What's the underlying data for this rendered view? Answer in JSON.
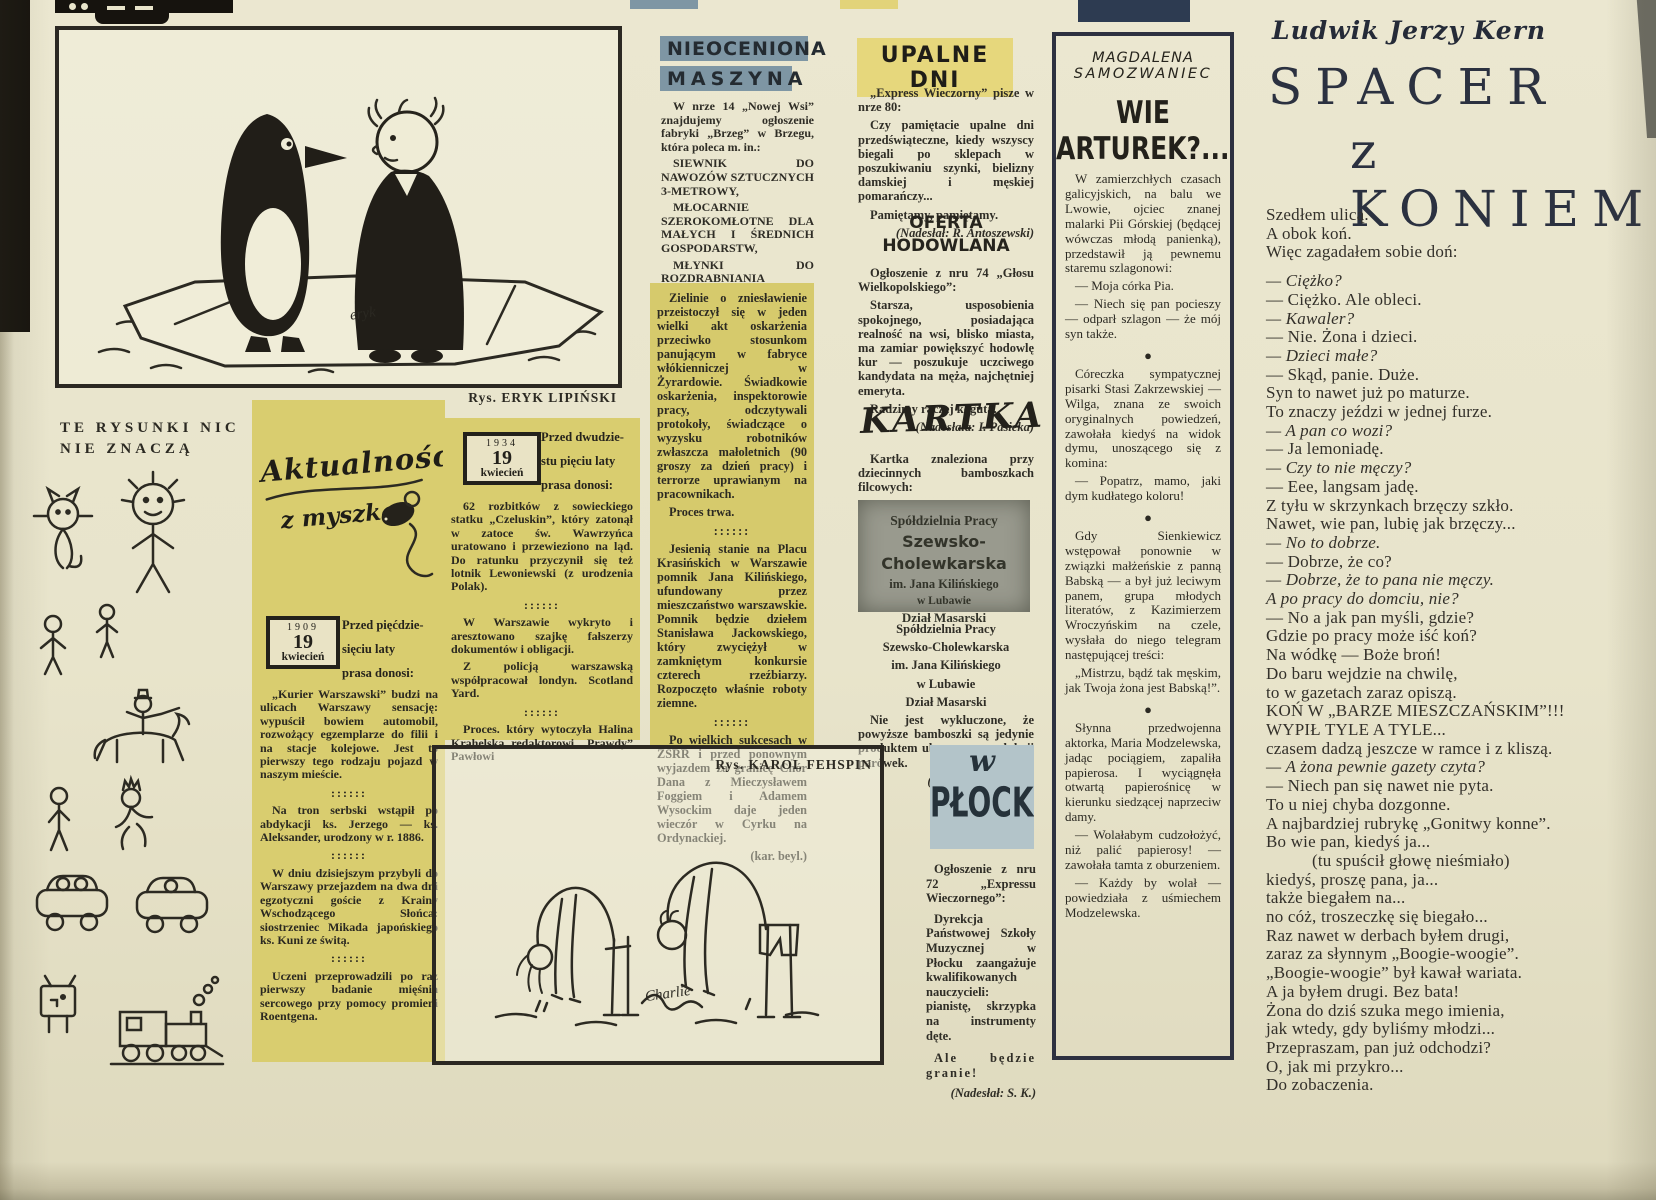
{
  "colors": {
    "paper": "#e8e4cb",
    "highlight_yellow": "#d9cd6f",
    "green_box": "#d6ca6c",
    "header_blue": "#7e96a4",
    "header_yellow": "#e6d77c",
    "plocku_blue": "#b3c4c9",
    "clipping_gray": "#999a8e",
    "masthead_navy": "#2d3b51",
    "ink": "#2b2922"
  },
  "doodles": {
    "header_line1": "TE RYSUNKI NIC",
    "header_line2": "NIE ZNACZĄ"
  },
  "cartoon_top": {
    "caption": "Rys. ERYK LIPIŃSKI",
    "signature": "eryk"
  },
  "cartoon_bottom": {
    "caption": "Rys. KAROL FEHSPIN",
    "signature": "Charlie"
  },
  "aktualnosci": {
    "logo_line1": "Aktualności",
    "logo_line2": "z myszką",
    "stamp1": {
      "year": "1909",
      "day": "19",
      "month": "kwiecień"
    },
    "stamp1_intro": [
      "Przed pięćdzie-",
      "sięciu laty",
      "prasa donosi:"
    ],
    "col1_paras": [
      {
        "t": "„Kurier Warszawski” budzi na ulicach Warszawy sensację: wypuścił bowiem automobil, rozwożący egzemplarze do filii i na stacje kolejowe. Jest to pierwszy tego rodzaju pojazd w naszym mieście.",
        "s": ""
      },
      {
        "t": "::::::",
        "s": "divider"
      },
      {
        "t": "Na tron serbski wstąpił po abdykacji ks. Jerzego — ks. Aleksander, urodzony w r. 1886.",
        "s": ""
      },
      {
        "t": "::::::",
        "s": "divider"
      },
      {
        "t": "W dniu dzisiejszym przybyli do Warszawy przejazdem na dwa dni egzotyczni goście z Krainy Wschodzącego Słońca: siostrzeniec Mikada japońskiego ks. Kuni ze świtą.",
        "s": ""
      },
      {
        "t": "::::::",
        "s": "divider"
      },
      {
        "t": "Uczeni przeprowadzili po raz pierwszy badanie mięśnia sercowego przy pomocy promieni Roentgena.",
        "s": ""
      }
    ],
    "stamp2": {
      "year": "1934",
      "day": "19",
      "month": "kwiecień"
    },
    "stamp2_intro": [
      "Przed dwudzie-",
      "stu pięciu laty",
      "prasa donosi:"
    ],
    "col2_paras": [
      {
        "t": "62 rozbitków z sowieckiego statku „Czeluskin”, który zatonął w zatoce św. Wawrzyńca uratowano i przewieziono na ląd. Do ratunku przyczynił się też lotnik Lewoniewski (z urodzenia Polak).",
        "s": ""
      },
      {
        "t": "::::::",
        "s": "divider"
      },
      {
        "t": "W Warszawie wykryto i aresztowano szajkę fałszerzy dokumentów i obligacji.",
        "s": ""
      },
      {
        "t": "Z policją warszawską współpracował londyn. Scotland Yard.",
        "s": ""
      },
      {
        "t": "::::::",
        "s": "divider"
      },
      {
        "t": "Proces. który wytoczyła Halina Krahelska redaktorowi „Prawdy” Pawłowi",
        "s": ""
      }
    ]
  },
  "nieoceniona": {
    "title_line1": "NIEOCENIONA",
    "title_line2": "MASZYNA",
    "paras": [
      {
        "t": "W nrze 14 „Nowej Wsi” znajdujemy ogłoszenie fabryki „Brzeg” w Brzegu, która poleca m. in.:",
        "s": ""
      },
      {
        "t": "SIEWNIK DO NAWOZÓW SZTUCZNYCH 3-METROWY,",
        "s": "bold"
      },
      {
        "t": "MŁOCARNIE SZEROKOMŁOTNE DLA MAŁYCH I ŚREDNICH GOSPODARSTW,",
        "s": "bold"
      },
      {
        "t": "MŁYNKI DO ROZDRABNIANIA NAWOZÓW MRN.",
        "s": "bold"
      },
      {
        "t": "Po zbyt długich posiedzeniach.",
        "s": ""
      },
      {
        "t": "(Nadesłał: B. Buharewicz)",
        "s": "credit"
      }
    ]
  },
  "greenbox": {
    "paras": [
      {
        "t": "Zielinie o zniesławienie przeistoczył się w jeden wielki akt oskarżenia przeciwko stosunkom panującym w fabryce włókienniczej w Żyrardowie. Świadkowie oskarżenia, inspektorowie pracy, odczytywali protokoły, świadczące o wyzysku robotników zwłaszcza małoletnich (90 groszy za dzień pracy) i terrorze uprawianym na pracownikach.",
        "s": ""
      },
      {
        "t": "Proces trwa.",
        "s": ""
      },
      {
        "t": "::::::",
        "s": "divider"
      },
      {
        "t": "Jesienią stanie na Placu Krasińskich w Warszawie pomnik Jana Kilińskiego, ufundowany przez mieszczaństwo warszawskie. Pomnik będzie dziełem Stanisława Jackowskiego, który zwyciężył w zamkniętym konkursie czterech rzeźbiarzy. Rozpoczęto właśnie roboty ziemne.",
        "s": ""
      },
      {
        "t": "::::::",
        "s": "divider"
      },
      {
        "t": "Po wielkich sukcesach w ZSRR i przed ponownym wyjazdem za granicę Chór Dana z Mieczysławem Foggiem i Adamem Wysockim daje jeden wieczór w Cyrku na Ordynackiej.",
        "s": ""
      },
      {
        "t": "(kar. beyl.)",
        "s": "creditb"
      }
    ]
  },
  "upalne": {
    "title": "UPALNE DNI",
    "paras": [
      {
        "t": "„Express Wieczorny” pisze w nrze 80:",
        "s": ""
      },
      {
        "t": "Czy pamiętacie upalne dni przedświąteczne, kiedy wszyscy biegali po sklepach w poszukiwaniu szynki, bielizny damskiej i męskiej pomarańczy...",
        "s": ""
      },
      {
        "t": "Pamiętamy, pamiętamy.",
        "s": ""
      },
      {
        "t": "(Nadesłał: R. Antoszewski)",
        "s": "credit"
      }
    ]
  },
  "oferta": {
    "title_line1": "OFERTA",
    "title_line2": "HODOWLANA",
    "paras": [
      {
        "t": "Ogłoszenie z nru 74 „Głosu Wielkopolskiego”:",
        "s": ""
      },
      {
        "t": "Starsza, usposobienia spokojnego, posiadająca realność na wsi, blisko miasta, ma zamiar powiększyć hodowlę kur — poszukuje uczciwego kandydata na męża, najchętniej emeryta.",
        "s": ""
      },
      {
        "t": "Radzimy raczej koguta.",
        "s": ""
      },
      {
        "t": "(Nadesłała: I. Pasieka)",
        "s": "credit"
      }
    ]
  },
  "kartka": {
    "title": "KARTKA",
    "intro_paras": [
      {
        "t": "Kartka znaleziona przy dziecinnych bamboszkach filcowych:",
        "s": ""
      }
    ],
    "clipping": [
      "Spółdzielnia Pracy",
      "Szewsko-Cholewkarska",
      "im. Jana Kilińskiego",
      "w Lubawie",
      "Dział Masarski"
    ],
    "paras": [
      {
        "t": "Spółdzielnia Pracy",
        "s": "cb"
      },
      {
        "t": "Szewsko-Cholewkarska",
        "s": "cb"
      },
      {
        "t": "im. Jana Kilińskiego",
        "s": "cb"
      },
      {
        "t": "w Lubawie",
        "s": "cb"
      },
      {
        "t": "Dział Masarski",
        "s": "cb"
      },
      {
        "t": "Nie jest wykluczone, że powyższe bamboszki są jedynie produktem ubocznym produkcji parówek.",
        "s": ""
      },
      {
        "t": "(Nadesłała: D. Beer)",
        "s": "credit"
      }
    ]
  },
  "plocku": {
    "title_w": "w",
    "title_name": "PŁOCKU",
    "paras": [
      {
        "t": "Ogłoszenie z nru 72 „Expressu Wieczornego”:",
        "s": ""
      },
      {
        "t": "Dyrekcja Państwowej Szkoły Muzycznej w Płocku zaangażuje kwalifikowanych nauczycieli: pianistę, skrzypka na instrumenty dęte.",
        "s": ""
      },
      {
        "t": "Ale będzie granie!",
        "s": "spaced"
      },
      {
        "t": "(Nadesłał: S. K.)",
        "s": "credit"
      }
    ]
  },
  "samozwaniec": {
    "author_line1": "MAGDALENA",
    "author_line2": "SAMOZWANIEC",
    "title": "WIE ARTUREK?....",
    "paras": [
      {
        "t": "W zamierzchłych czasach galicyjskich, na balu we Lwowie, ojciec znanej malarki Pii Górskiej (będącej wówczas młodą panienką), przedstawił ją pewnemu staremu szlagonowi:",
        "s": ""
      },
      {
        "t": "— Moja córka Pia.",
        "s": ""
      },
      {
        "t": "— Niech się pan pocieszy — odparł szlagon — że mój syn także.",
        "s": ""
      },
      {
        "t": "●",
        "s": "bullet"
      },
      {
        "t": "Córeczka sympatycznej pisarki Stasi Zakrzewskiej — Wilga, znana ze swoich oryginalnych powiedzeń, zawołała kiedyś na widok dymu, unoszącego się z komina:",
        "s": ""
      },
      {
        "t": "— Popatrz, mamo, jaki dym kudłatego koloru!",
        "s": ""
      },
      {
        "t": "●",
        "s": "bullet"
      },
      {
        "t": "Gdy Sienkiewicz wstępował ponownie w związki małżeńskie z panną Babską — a był już leciwym panem, grupa młodych literatów, z Kazimierzem Wroczyńskim na czele, wysłała do niego telegram następującej treści:",
        "s": ""
      },
      {
        "t": "„Mistrzu, bądź tak męskim, jak Twoja żona jest Babską!”.",
        "s": ""
      },
      {
        "t": "●",
        "s": "bullet"
      },
      {
        "t": "Słynna przedwojenna aktorka, Maria Modzelewska, jadąc pociągiem, zapaliła papierosa. I wyciągnęła otwartą papierośnicę w kierunku siedzącej naprzeciw damy.",
        "s": ""
      },
      {
        "t": "— Wolałabym cudzołożyć, niż palić papierosy! — zawołała tamta z oburzeniem.",
        "s": ""
      },
      {
        "t": "— Każdy by wolał — powiedziała z uśmiechem Modzelewska.",
        "s": ""
      }
    ]
  },
  "kern": {
    "author": "Ludwik Jerzy Kern",
    "title_line1": "SPACER",
    "title_line2": "z KONIEM",
    "poem": [
      {
        "t": "Szedłem ulicą.",
        "s": ""
      },
      {
        "t": "A obok koń.",
        "s": ""
      },
      {
        "t": "Więc zagadałem sobie doń:",
        "s": ""
      },
      {
        "t": "",
        "s": "gap"
      },
      {
        "t": "— Ciężko?",
        "s": "i"
      },
      {
        "t": "— Ciężko. Ale obleci.",
        "s": ""
      },
      {
        "t": "— Kawaler?",
        "s": "i"
      },
      {
        "t": "— Nie. Żona i dzieci.",
        "s": ""
      },
      {
        "t": "— Dzieci małe?",
        "s": "i"
      },
      {
        "t": "— Skąd, panie. Duże.",
        "s": ""
      },
      {
        "t": "Syn to nawet już po maturze.",
        "s": ""
      },
      {
        "t": "To znaczy jeździ w jednej furze.",
        "s": ""
      },
      {
        "t": "— A pan co wozi?",
        "s": "i"
      },
      {
        "t": "— Ja lemoniadę.",
        "s": ""
      },
      {
        "t": "— Czy to nie męczy?",
        "s": "i"
      },
      {
        "t": "— Eee, langsam jadę.",
        "s": ""
      },
      {
        "t": "Z tyłu w skrzynkach brzęczy szkło.",
        "s": ""
      },
      {
        "t": "Nawet, wie pan, lubię jak brzęczy...",
        "s": ""
      },
      {
        "t": "— No to dobrze.",
        "s": "i"
      },
      {
        "t": "— Dobrze, że co?",
        "s": ""
      },
      {
        "t": "— Dobrze, że to pana nie męczy.",
        "s": "i"
      },
      {
        "t": "A po pracy do domciu, nie?",
        "s": "i"
      },
      {
        "t": "— No a jak pan myśli, gdzie?",
        "s": ""
      },
      {
        "t": "Gdzie po pracy może iść koń?",
        "s": ""
      },
      {
        "t": "Na wódkę — Boże broń!",
        "s": ""
      },
      {
        "t": "Do baru wejdzie na chwilę,",
        "s": ""
      },
      {
        "t": "to w gazetach zaraz opiszą.",
        "s": ""
      },
      {
        "t": "KOŃ W „BARZE MIESZCZAŃSKIM”!!!",
        "s": ""
      },
      {
        "t": "WYPIŁ TYLE A TYLE...",
        "s": ""
      },
      {
        "t": "czasem dadzą jeszcze w ramce i z kliszą.",
        "s": ""
      },
      {
        "t": "— A żona pewnie gazety czyta?",
        "s": "i"
      },
      {
        "t": "— Niech pan się nawet nie pyta.",
        "s": ""
      },
      {
        "t": "To u niej chyba dozgonne.",
        "s": ""
      },
      {
        "t": "A najbardziej rubrykę „Gonitwy konne”.",
        "s": ""
      },
      {
        "t": "Bo wie pan, kiedyś ja...",
        "s": ""
      },
      {
        "t": "(tu spuścił głowę nieśmiało)",
        "s": "ind"
      },
      {
        "t": "kiedyś, proszę pana, ja...",
        "s": ""
      },
      {
        "t": "także biegałem na...",
        "s": ""
      },
      {
        "t": "no cóż, troszeczkę się biegało...",
        "s": ""
      },
      {
        "t": "Raz nawet w derbach byłem drugi,",
        "s": ""
      },
      {
        "t": "zaraz za słynnym „Boogie-woogie”.",
        "s": ""
      },
      {
        "t": "„Boogie-woogie” był kawał wariata.",
        "s": ""
      },
      {
        "t": "A ja byłem drugi. Bez bata!",
        "s": ""
      },
      {
        "t": "Żona do dziś szuka mego imienia,",
        "s": ""
      },
      {
        "t": "jak wtedy, gdy byliśmy młodzi...",
        "s": ""
      },
      {
        "t": "Przepraszam, pan już odchodzi?",
        "s": ""
      },
      {
        "t": "O, jak mi przykro...",
        "s": ""
      },
      {
        "t": "Do zobaczenia.",
        "s": ""
      }
    ]
  }
}
